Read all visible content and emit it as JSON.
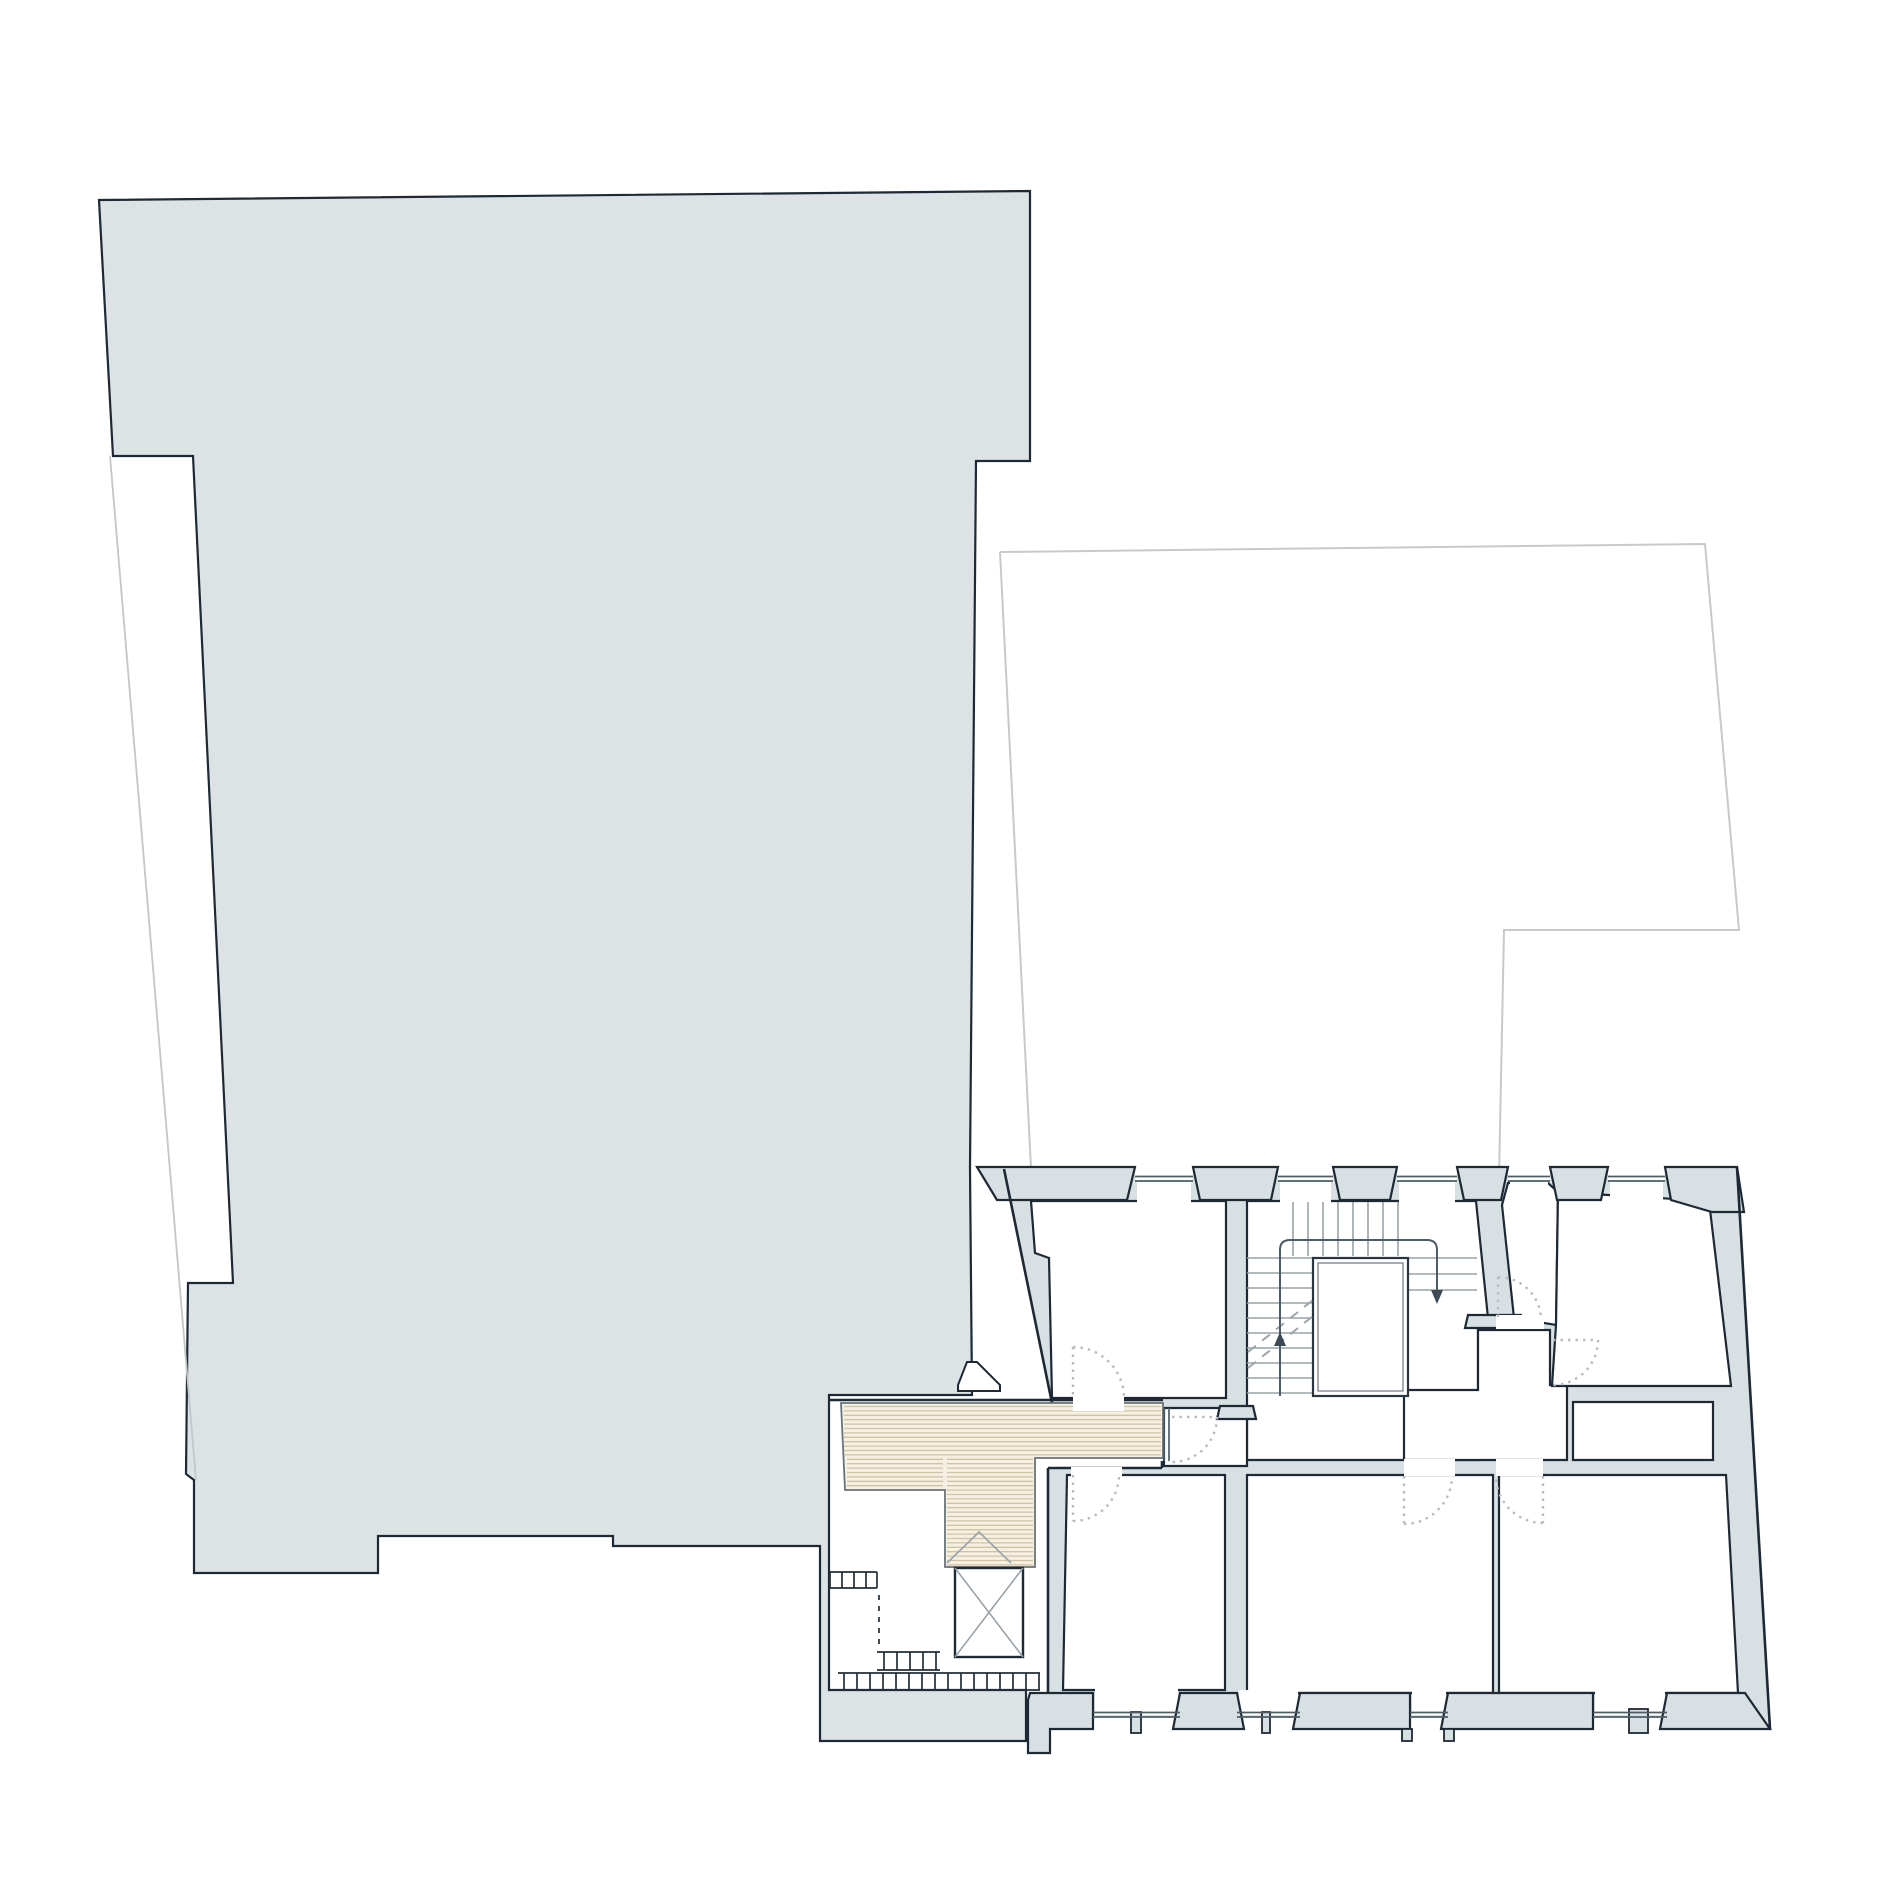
{
  "page": {
    "type": "architectural site and floor plan drawing",
    "background": "#ffffff",
    "text_labels": []
  },
  "colors": {
    "site_fill": "#dde3e5",
    "wall_fill": "#d9e0e3",
    "outline_dark": "#1d2935",
    "thin_line": "#9aa3a9",
    "window_line": "#4e5c66",
    "parcel_line": "#c6cacc",
    "door_arc": "#b7bdc0",
    "deck_fill": "#f5f0e2",
    "deck_hatch": "#d0c3a5",
    "shaft_fill": "#ffffff"
  },
  "plan": {
    "neighbor_mass": {
      "shaded": true,
      "notch_on_left_edge": true
    },
    "adjacent_parcel_outline": {
      "visible": true,
      "stroke": "light-gray"
    },
    "building": {
      "rooms_white": 9,
      "windows_top_wall": 5,
      "windows_bottom_wall": 4,
      "door_swing_arcs": 7,
      "right_wall_slanted": true
    },
    "stair": {
      "upper_flight_treads": 8,
      "left_flight_treads": 10,
      "right_flight_treads": 3,
      "central_shaft": true,
      "up_arrow": true,
      "down_arrow": true,
      "dashed_break_lines": 2
    },
    "deck": {
      "hatch_direction": "horizontal",
      "cross_braced_shaft": true,
      "exterior_steps": true
    }
  }
}
